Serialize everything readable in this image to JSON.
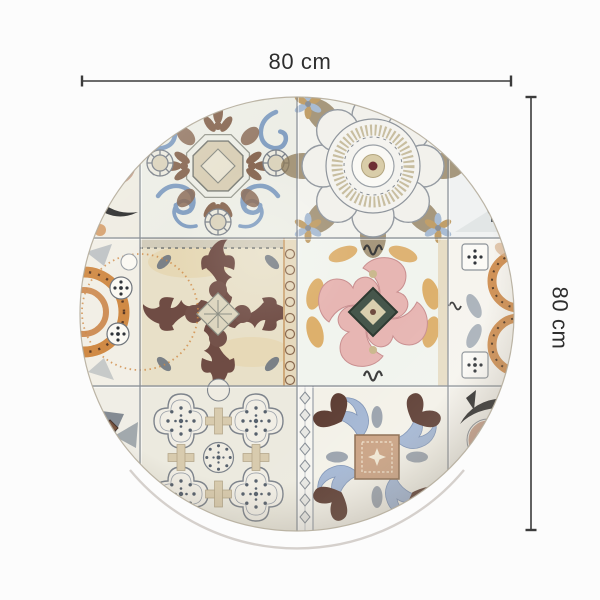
{
  "page": {
    "background_color": "#fcfcfc"
  },
  "dimension_annotation": {
    "width_label": "80 cm",
    "height_label": "80 cm",
    "line_color": "#3b3b3b",
    "label_color": "#2e2e2e"
  },
  "product_image": {
    "type": "round vinyl mat printed with vintage azulejo patchwork tiles",
    "shape": "circle",
    "tiles": {
      "top_left": "blue and brown baroque scroll tile with octagon medallion",
      "top_right": "grey scalloped rosette medallion tile with dark red center dot",
      "middle_left": "maroon damask ornament tile on aged beige",
      "middle_right": "pink scroll tile with dark green diamond center and orange leaves",
      "bottom_left": "grey quatrefoil lattice tile with dotted rosettes",
      "bottom_right": "blue, brown and tan ornamental tile with center square",
      "left_edge": "black eye, orange wheel and grey pinwheel border tiles",
      "right_edge": "pale leaf, orange arc and black eye border tiles"
    },
    "palette": {
      "cream": "#efe9d9",
      "slate_blue": "#8fa6c4",
      "brown": "#8a6a55",
      "maroon": "#6f4c44",
      "pink": "#e7b6b3",
      "dark_green": "#46564b",
      "orange": "#d08a45",
      "grey": "#8f959d",
      "tan": "#c8a18c",
      "black": "#2d2d2d",
      "dark_red": "#6e2f34"
    }
  }
}
